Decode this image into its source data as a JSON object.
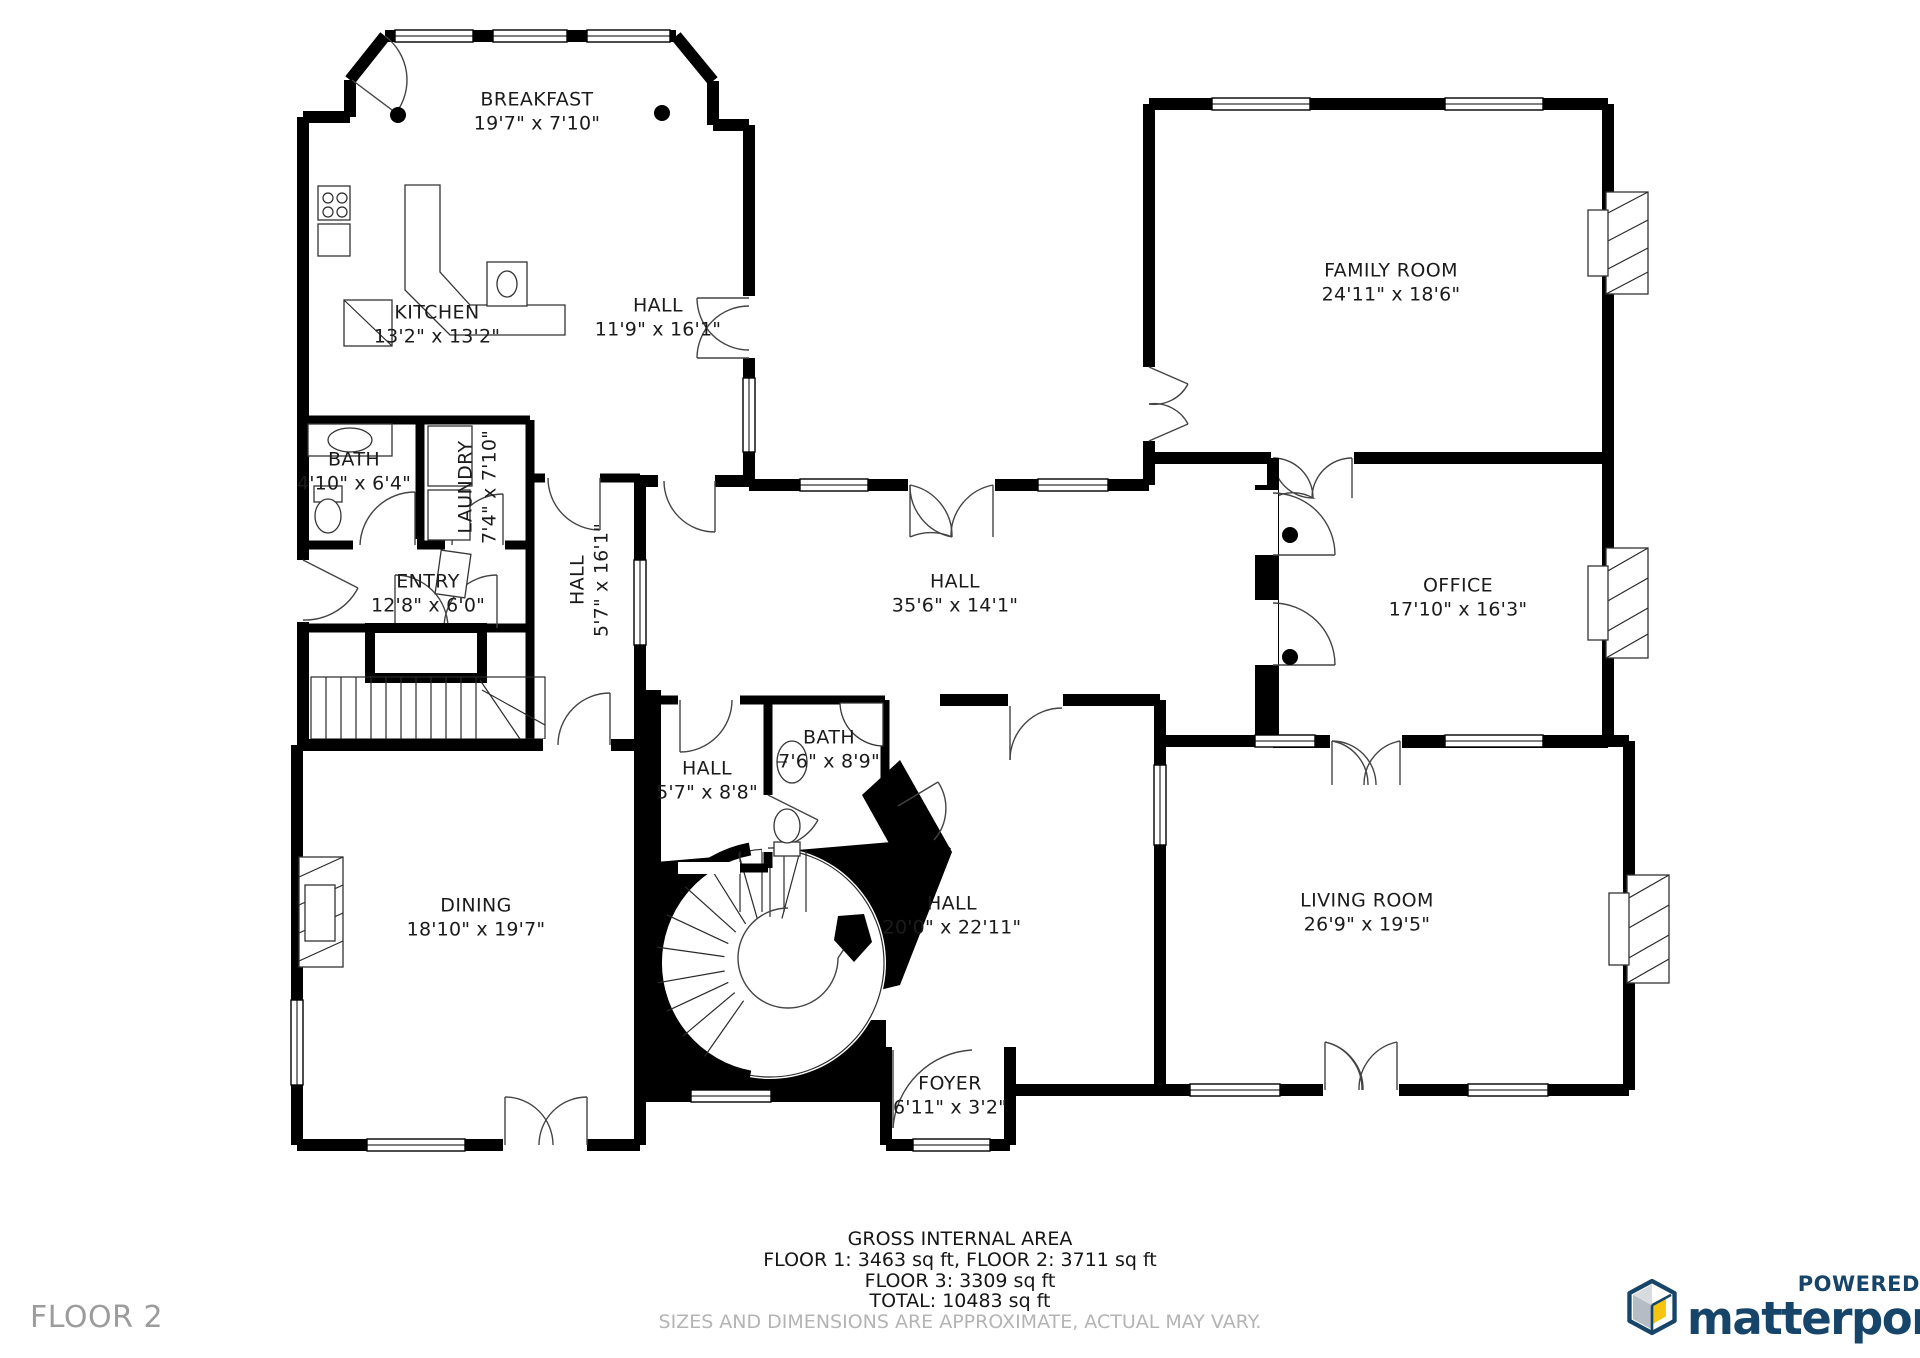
{
  "floor_label": "FLOOR 2",
  "rooms": [
    {
      "id": "breakfast",
      "name": "BREAKFAST",
      "dims": "19'7\" x 7'10\""
    },
    {
      "id": "kitchen",
      "name": "KITCHEN",
      "dims": "13'2\" x 13'2\""
    },
    {
      "id": "hall-upper",
      "name": "HALL",
      "dims": "11'9\" x 16'1\""
    },
    {
      "id": "family-room",
      "name": "FAMILY ROOM",
      "dims": "24'11\" x 18'6\""
    },
    {
      "id": "bath-left",
      "name": "BATH",
      "dims": "4'10\" x 6'4\""
    },
    {
      "id": "laundry",
      "name": "LAUNDRY",
      "dims": "7'4\" x 7'10\""
    },
    {
      "id": "entry",
      "name": "ENTRY",
      "dims": "12'8\" x 6'0\""
    },
    {
      "id": "hall-vertical",
      "name": "HALL",
      "dims": "5'7\" x 16'1\""
    },
    {
      "id": "hall-center",
      "name": "HALL",
      "dims": "35'6\" x 14'1\""
    },
    {
      "id": "office",
      "name": "OFFICE",
      "dims": "17'10\" x 16'3\""
    },
    {
      "id": "hall-small",
      "name": "HALL",
      "dims": "5'7\" x 8'8\""
    },
    {
      "id": "bath-center",
      "name": "BATH",
      "dims": "7'6\" x 8'9\""
    },
    {
      "id": "dining",
      "name": "DINING",
      "dims": "18'10\" x 19'7\""
    },
    {
      "id": "hall-lower",
      "name": "HALL",
      "dims": "20'0\" x 22'11\""
    },
    {
      "id": "living-room",
      "name": "LIVING ROOM",
      "dims": "26'9\" x 19'5\""
    },
    {
      "id": "foyer",
      "name": "FOYER",
      "dims": "6'11\" x 3'2\""
    }
  ],
  "footer": {
    "title": "GROSS INTERNAL AREA",
    "line1": "FLOOR 1: 3463 sq ft, FLOOR 2: 3711 sq ft",
    "line2": "FLOOR 3: 3309 sq ft",
    "line3": "TOTAL: 10483 sq ft",
    "disclaimer": "SIZES AND DIMENSIONS ARE APPROXIMATE, ACTUAL MAY VARY."
  },
  "branding": {
    "powered_by": "POWERED BY",
    "brand": "matterport",
    "registered": "®"
  },
  "colors": {
    "wall": "#000000",
    "brand_navy": "#164569",
    "logo_yellow": "#F5C50D",
    "logo_gray": "#B6BCC3",
    "floor_label_gray": "#9C9C9C",
    "disclaimer_gray": "#B4B4B4"
  }
}
